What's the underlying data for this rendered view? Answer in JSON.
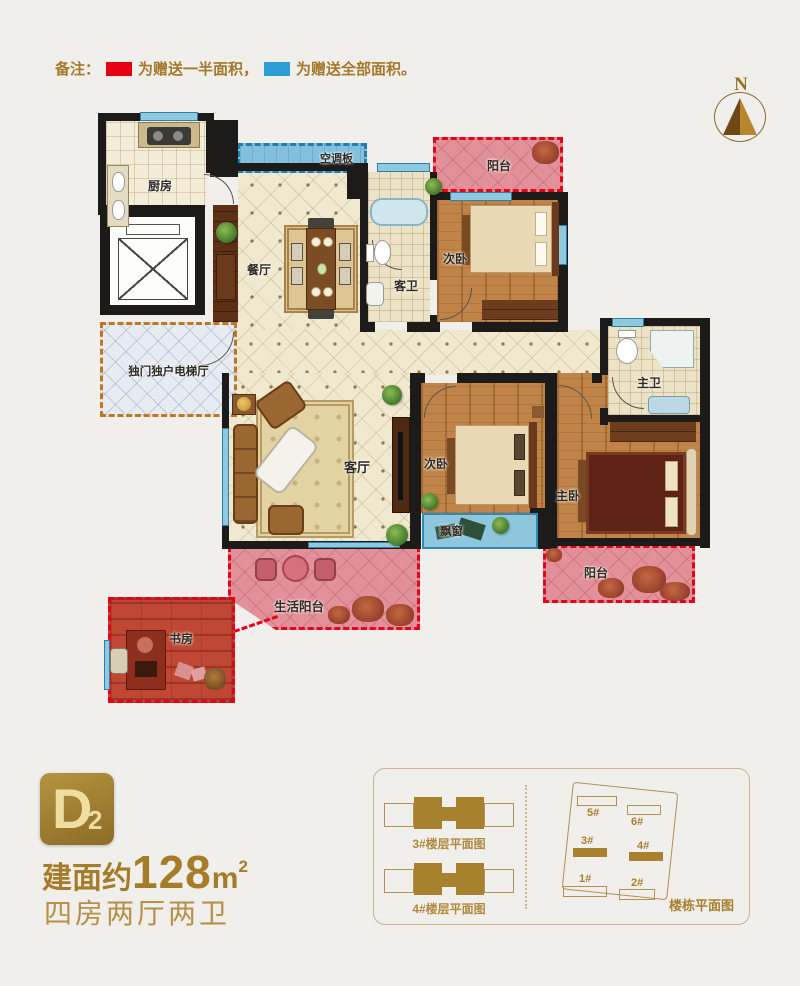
{
  "legend": {
    "prefix": "备注：",
    "half": "为赠送一半面积，",
    "full": "为赠送全部面积。",
    "half_color": "#e60012",
    "full_color": "#2e9fd6"
  },
  "compass": {
    "north": "N"
  },
  "floorplan": {
    "kitchen": "厨房",
    "dining": "餐厅",
    "ac_panel": "空调板",
    "balcony_top": "阳台",
    "bedroom_top": "次卧",
    "guest_bath": "客卫",
    "elevator_hall": "独门独户电梯厅",
    "living": "客厅",
    "bedroom_mid": "次卧",
    "master_bath": "主卫",
    "master_bedroom": "主卧",
    "bay_window": "飘窗",
    "balcony_bottom": "阳台",
    "life_balcony": "生活阳台",
    "study": "书房"
  },
  "unit": {
    "letter": "D",
    "number": "2",
    "area_prefix": "建面约",
    "area_value": "128",
    "area_unit": "m",
    "area_exp": "2",
    "rooms_text": "四房两厅两卫"
  },
  "plans": {
    "floor3": "3#楼层平面图",
    "floor4": "4#楼层平面图",
    "site": "楼栋平面图",
    "b1": "1#",
    "b2": "2#",
    "b3": "3#",
    "b4": "4#",
    "b5": "5#",
    "b6": "6#"
  }
}
